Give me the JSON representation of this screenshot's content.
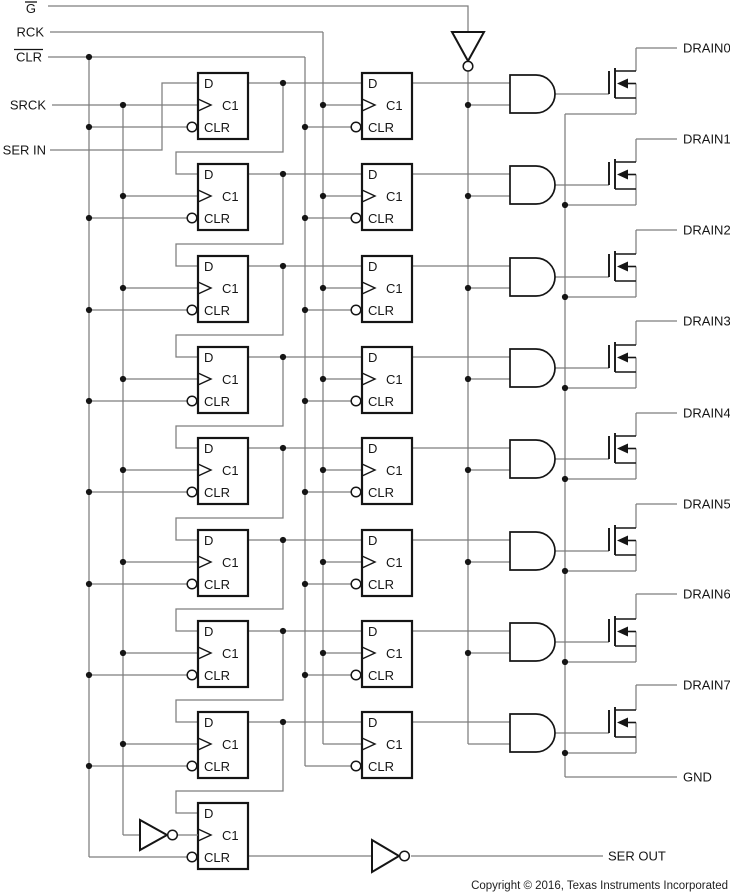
{
  "inputs": [
    {
      "label": "G",
      "overline": true
    },
    {
      "label": "RCK",
      "overline": false
    },
    {
      "label": "CLR",
      "overline": true
    },
    {
      "label": "SRCK",
      "overline": false
    },
    {
      "label": "SER IN",
      "overline": false
    }
  ],
  "ff": {
    "d": "D",
    "clock": "C1",
    "clear": "CLR"
  },
  "outputs": {
    "drains": [
      "DRAIN0",
      "DRAIN1",
      "DRAIN2",
      "DRAIN3",
      "DRAIN4",
      "DRAIN5",
      "DRAIN6",
      "DRAIN7"
    ],
    "ground": "GND",
    "serial": "SER OUT"
  },
  "footer": {
    "copyright": "Copyright © 2016, Texas Instruments Incorporated"
  },
  "colors": {
    "wire": "#7d7d7d",
    "ink": "#151515",
    "background": "#ffffff"
  }
}
